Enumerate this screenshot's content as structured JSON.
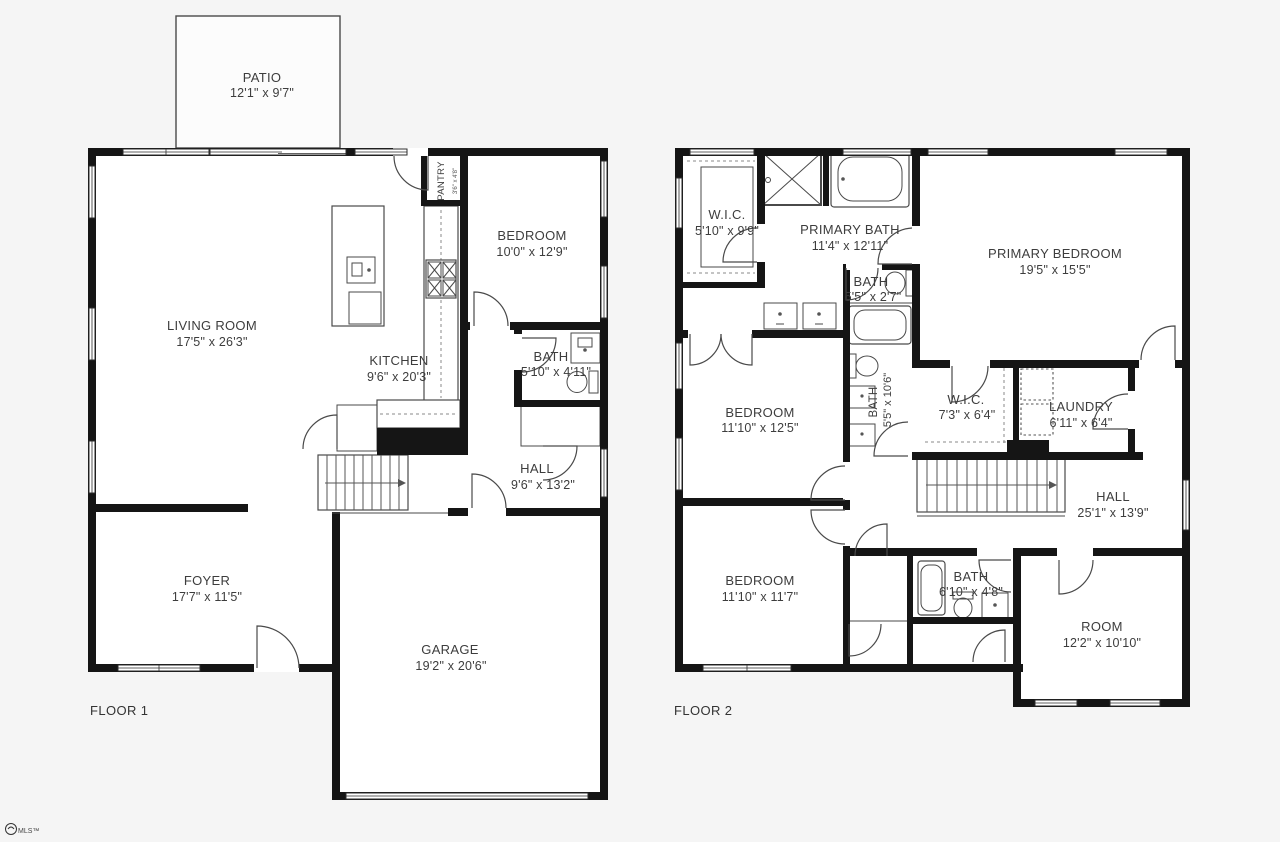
{
  "colors": {
    "background": "#f5f5f5",
    "wall": "#151515",
    "line": "#4a4a4a",
    "room_fill": "#ffffff",
    "text": "#3d3d3d"
  },
  "floor1": {
    "label": "FLOOR 1",
    "patio": {
      "name": "PATIO",
      "dims": "12'1\" x 9'7\""
    },
    "living_room": {
      "name": "LIVING ROOM",
      "dims": "17'5\" x 26'3\""
    },
    "kitchen": {
      "name": "KITCHEN",
      "dims": "9'6\" x 20'3\""
    },
    "pantry": {
      "name": "PANTRY",
      "dims": "3'6\" x 4'8\""
    },
    "bedroom": {
      "name": "BEDROOM",
      "dims": "10'0\" x 12'9\""
    },
    "bath": {
      "name": "BATH",
      "dims": "5'10\" x 4'11\""
    },
    "hall": {
      "name": "HALL",
      "dims": "9'6\" x 13'2\""
    },
    "foyer": {
      "name": "FOYER",
      "dims": "17'7\" x 11'5\""
    },
    "garage": {
      "name": "GARAGE",
      "dims": "19'2\" x 20'6\""
    }
  },
  "floor2": {
    "label": "FLOOR 2",
    "wic_primary": {
      "name": "W.I.C.",
      "dims": "5'10\" x 9'9\""
    },
    "primary_bath": {
      "name": "PRIMARY BATH",
      "dims": "11'4\" x 12'11\""
    },
    "toilet_room": {
      "name": "BATH",
      "dims": "5'5\" x 2'7\""
    },
    "primary_bedroom": {
      "name": "PRIMARY BEDROOM",
      "dims": "19'5\" x 15'5\""
    },
    "bedroom_mid": {
      "name": "BEDROOM",
      "dims": "11'10\" x 12'5\""
    },
    "bath_mid": {
      "name": "BATH",
      "dims": "5'5\" x 10'6\""
    },
    "wic_hall": {
      "name": "W.I.C.",
      "dims": "7'3\" x 6'4\""
    },
    "laundry": {
      "name": "LAUNDRY",
      "dims": "6'11\" x 6'4\""
    },
    "hall": {
      "name": "HALL",
      "dims": "25'1\" x 13'9\""
    },
    "bedroom_lower": {
      "name": "BEDROOM",
      "dims": "11'10\" x 11'7\""
    },
    "bath_lower": {
      "name": "BATH",
      "dims": "6'10\" x 4'8\""
    },
    "room": {
      "name": "ROOM",
      "dims": "12'2\" x 10'10\""
    }
  },
  "watermark": {
    "text": "MLS™"
  }
}
